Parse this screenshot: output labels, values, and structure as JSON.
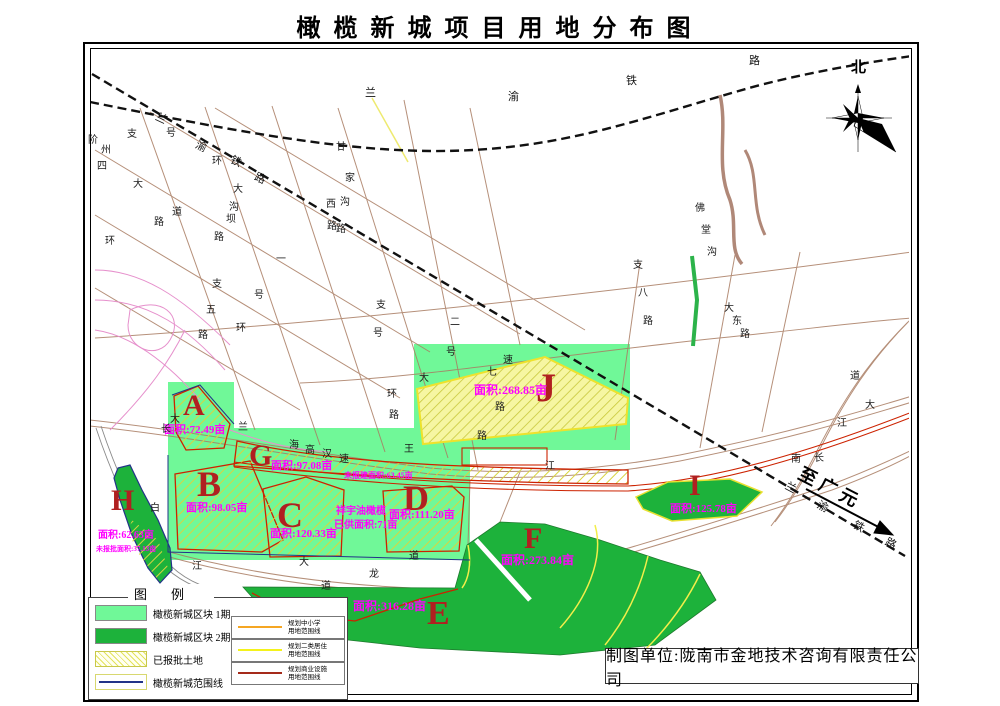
{
  "title": "橄榄新城项目用地分布图",
  "compass": {
    "north_label": "北"
  },
  "direction_note": {
    "text": "至广元"
  },
  "caption": {
    "text": "制图单位:陇南市金地技术咨询有限责任公司"
  },
  "legend": {
    "title": "图例",
    "area_items": [
      {
        "label": "橄榄新城区块 1期",
        "swatch": "fill-light"
      },
      {
        "label": "橄榄新城区块 2期",
        "swatch": "fill-dark"
      },
      {
        "label": "已报批土地",
        "swatch": "hatch"
      },
      {
        "label": "橄榄新城范围线",
        "swatch": "line-blue"
      }
    ],
    "line_items": [
      {
        "line1": "规划中小学",
        "line2": "用地范围线",
        "color": "#f5a623"
      },
      {
        "line1": "规划二类居住",
        "line2": "用地范围线",
        "color": "#f4f21c"
      },
      {
        "line1": "规划商业设施",
        "line2": "用地范围线",
        "color": "#a52a1a"
      }
    ]
  },
  "zones": [
    {
      "id": "A",
      "letter": "A",
      "lx": 183,
      "ly": 391,
      "lfs": 30,
      "area": "面积:72.49亩",
      "ax": 164,
      "ay": 425,
      "afs": 11
    },
    {
      "id": "B",
      "letter": "B",
      "lx": 197,
      "ly": 466,
      "lfs": 36,
      "area": "面积:98.05亩",
      "ax": 186,
      "ay": 503,
      "afs": 11
    },
    {
      "id": "C",
      "letter": "C",
      "lx": 277,
      "ly": 497,
      "lfs": 36,
      "area": "面积:120.33亩",
      "ax": 270,
      "ay": 529,
      "afs": 11
    },
    {
      "id": "D",
      "letter": "D",
      "lx": 403,
      "ly": 480,
      "lfs": 36,
      "area": "面积:111.20亩",
      "ax": 389,
      "ay": 510,
      "afs": 11
    },
    {
      "id": "G",
      "letter": "G",
      "lx": 249,
      "ly": 441,
      "lfs": 30,
      "area": "面积:97.08亩",
      "ax": 271,
      "ay": 461,
      "afs": 11,
      "extra": "未报建面积:63.45亩",
      "ex": 344,
      "ey": 472,
      "efs": 8
    },
    {
      "id": "J",
      "letter": "J",
      "lx": 536,
      "ly": 368,
      "lfs": 40,
      "area": "面积:268.85亩",
      "ax": 474,
      "ay": 384,
      "afs": 12
    },
    {
      "id": "E",
      "letter": "E",
      "lx": 427,
      "ly": 597,
      "lfs": 34,
      "area": "面积:316.28亩",
      "ax": 353,
      "ay": 600,
      "afs": 12
    },
    {
      "id": "F",
      "letter": "F",
      "lx": 524,
      "ly": 524,
      "lfs": 30,
      "area": "面积:273.84亩",
      "ax": 501,
      "ay": 554,
      "afs": 12
    },
    {
      "id": "H",
      "letter": "H",
      "lx": 111,
      "ly": 486,
      "lfs": 30,
      "area": "面积:62.63亩",
      "ax": 98,
      "ay": 531,
      "afs": 10,
      "extra": "未报批面积:37.13亩",
      "ex": 96,
      "ey": 546,
      "efs": 7
    },
    {
      "id": "I",
      "letter": "I",
      "lx": 689,
      "ly": 471,
      "lfs": 30,
      "area": "面积:125.78亩",
      "ax": 670,
      "ay": 504,
      "afs": 11
    }
  ],
  "notes": [
    {
      "text": "祥宇油橄榄",
      "x": 336,
      "y": 507,
      "fs": 10
    },
    {
      "text": "已供面积:71亩",
      "x": 334,
      "y": 521,
      "fs": 10
    }
  ],
  "railway_labels": [
    {
      "t": "兰",
      "x": 365,
      "y": 88
    },
    {
      "t": "渝",
      "x": 508,
      "y": 92
    },
    {
      "t": "铁",
      "x": 626,
      "y": 76
    },
    {
      "t": "路",
      "x": 749,
      "y": 56
    },
    {
      "t": "兰",
      "x": 158,
      "y": 112,
      "r": 25
    },
    {
      "t": "渝",
      "x": 198,
      "y": 140,
      "r": 25
    },
    {
      "t": "铁",
      "x": 233,
      "y": 155,
      "r": 25
    },
    {
      "t": "路",
      "x": 257,
      "y": 172,
      "r": 25
    },
    {
      "t": "兰",
      "x": 788,
      "y": 481,
      "r": 28
    },
    {
      "t": "渝",
      "x": 820,
      "y": 500,
      "r": 28
    },
    {
      "t": "铁",
      "x": 856,
      "y": 520,
      "r": 28
    },
    {
      "t": "路",
      "x": 888,
      "y": 537,
      "r": 28
    }
  ],
  "road_labels": [
    {
      "t": "阶",
      "x": 88,
      "y": 136
    },
    {
      "t": "州",
      "x": 101,
      "y": 146
    },
    {
      "t": "四",
      "x": 97,
      "y": 162
    },
    {
      "t": "大",
      "x": 133,
      "y": 180
    },
    {
      "t": "道",
      "x": 172,
      "y": 208
    },
    {
      "t": "路",
      "x": 154,
      "y": 218
    },
    {
      "t": "支",
      "x": 127,
      "y": 130
    },
    {
      "t": "号",
      "x": 166,
      "y": 129
    },
    {
      "t": "环",
      "x": 212,
      "y": 157
    },
    {
      "t": "大",
      "x": 233,
      "y": 185
    },
    {
      "t": "沟",
      "x": 229,
      "y": 203
    },
    {
      "t": "坝",
      "x": 226,
      "y": 215
    },
    {
      "t": "路",
      "x": 214,
      "y": 233
    },
    {
      "t": "环",
      "x": 105,
      "y": 237
    },
    {
      "t": "支",
      "x": 212,
      "y": 280
    },
    {
      "t": "五",
      "x": 206,
      "y": 306
    },
    {
      "t": "路",
      "x": 198,
      "y": 331
    },
    {
      "t": "环",
      "x": 236,
      "y": 324
    },
    {
      "t": "甘",
      "x": 336,
      "y": 143
    },
    {
      "t": "家",
      "x": 345,
      "y": 174
    },
    {
      "t": "沟",
      "x": 340,
      "y": 198
    },
    {
      "t": "路",
      "x": 336,
      "y": 225
    },
    {
      "t": "西",
      "x": 326,
      "y": 200
    },
    {
      "t": "路",
      "x": 327,
      "y": 222
    },
    {
      "t": "一",
      "x": 276,
      "y": 255
    },
    {
      "t": "号",
      "x": 254,
      "y": 291
    },
    {
      "t": "支",
      "x": 376,
      "y": 301
    },
    {
      "t": "号",
      "x": 373,
      "y": 329
    },
    {
      "t": "二",
      "x": 450,
      "y": 318
    },
    {
      "t": "号",
      "x": 446,
      "y": 348
    },
    {
      "t": "长",
      "x": 161,
      "y": 425
    },
    {
      "t": "大",
      "x": 170,
      "y": 415
    },
    {
      "t": "兰",
      "x": 238,
      "y": 423
    },
    {
      "t": "海",
      "x": 289,
      "y": 441
    },
    {
      "t": "高",
      "x": 305,
      "y": 446
    },
    {
      "t": "汉",
      "x": 322,
      "y": 450
    },
    {
      "t": "速",
      "x": 339,
      "y": 455
    },
    {
      "t": "王",
      "x": 404,
      "y": 445
    },
    {
      "t": "环",
      "x": 387,
      "y": 390
    },
    {
      "t": "路",
      "x": 389,
      "y": 411
    },
    {
      "t": "大",
      "x": 419,
      "y": 374
    },
    {
      "t": "七",
      "x": 487,
      "y": 368
    },
    {
      "t": "路",
      "x": 495,
      "y": 403
    },
    {
      "t": "路",
      "x": 477,
      "y": 432
    },
    {
      "t": "速",
      "x": 503,
      "y": 356
    },
    {
      "t": "支",
      "x": 633,
      "y": 261
    },
    {
      "t": "八",
      "x": 638,
      "y": 289
    },
    {
      "t": "路",
      "x": 643,
      "y": 317
    },
    {
      "t": "大",
      "x": 724,
      "y": 304
    },
    {
      "t": "东",
      "x": 732,
      "y": 317
    },
    {
      "t": "路",
      "x": 740,
      "y": 330
    },
    {
      "t": "佛",
      "x": 695,
      "y": 204
    },
    {
      "t": "堂",
      "x": 701,
      "y": 226
    },
    {
      "t": "沟",
      "x": 707,
      "y": 248
    },
    {
      "t": "道",
      "x": 850,
      "y": 372
    },
    {
      "t": "大",
      "x": 865,
      "y": 401
    },
    {
      "t": "江",
      "x": 837,
      "y": 419
    },
    {
      "t": "南",
      "x": 791,
      "y": 455
    },
    {
      "t": "长",
      "x": 814,
      "y": 454
    },
    {
      "t": "白",
      "x": 150,
      "y": 504
    },
    {
      "t": "江",
      "x": 192,
      "y": 562
    },
    {
      "t": "大",
      "x": 299,
      "y": 558
    },
    {
      "t": "道",
      "x": 409,
      "y": 552
    },
    {
      "t": "龙",
      "x": 369,
      "y": 570
    },
    {
      "t": "道",
      "x": 321,
      "y": 582
    },
    {
      "t": "江",
      "x": 545,
      "y": 462
    }
  ],
  "colors": {
    "phase1_green": "#70f898",
    "phase2_green": "#1db23b",
    "hatch_yellow": "#e3e35c",
    "boundary_blue": "#223388",
    "red_line": "#cc2200",
    "magenta_label": "#ff00ff",
    "zone_letter_red": "#b02020"
  }
}
